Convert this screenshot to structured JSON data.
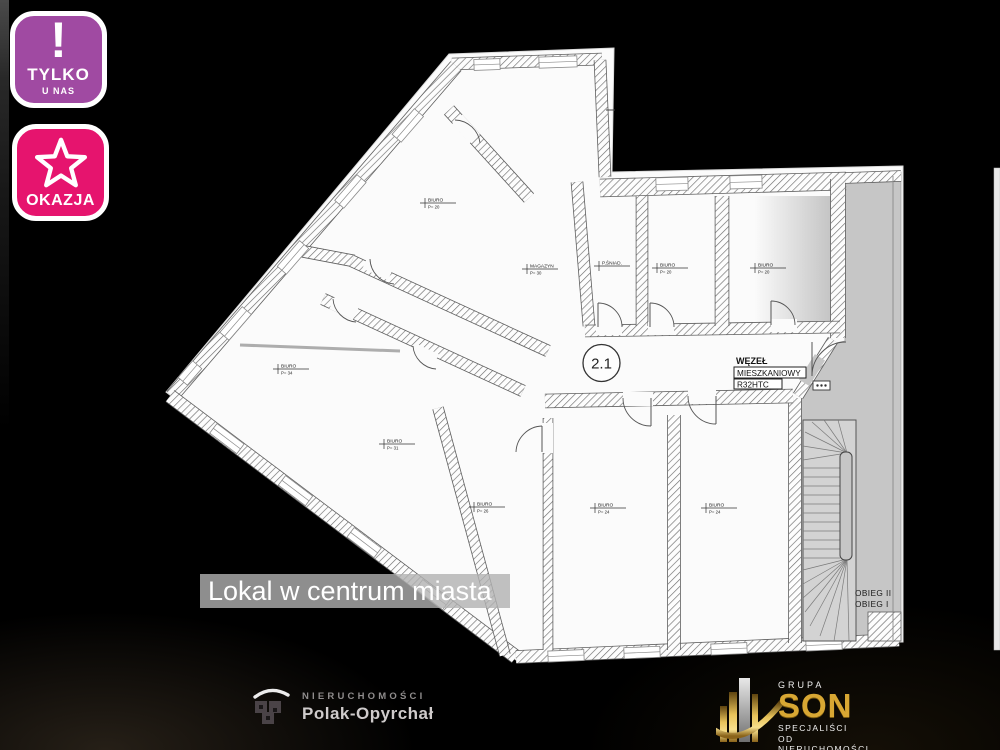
{
  "badges": {
    "tylko": {
      "mark": "!",
      "line1": "TYLKO",
      "line2": "U NAS",
      "bg": "#a04aa2"
    },
    "okazja": {
      "label": "OKAZJA",
      "bg": "#e6146e",
      "icon": "star-icon"
    }
  },
  "caption": {
    "text": "Lokal w centrum miasta"
  },
  "plan": {
    "unit_label": "2.1",
    "wezel": {
      "l1": "WĘZEŁ",
      "l2": "MIESZKANIOWY",
      "l3": "R32HTC"
    },
    "stairs": {
      "flight2": "OBIEG II",
      "flight1": "OBIEG I"
    },
    "rooms": [
      {
        "name": "BIURO",
        "area": "P= 20"
      },
      {
        "name": "MAGAZYN",
        "area": "P= 30"
      },
      {
        "name": "P.ŚNIAD.",
        "area": ""
      },
      {
        "name": "BIURO",
        "area": "P= 20"
      },
      {
        "name": "BIURO",
        "area": "P= 20"
      },
      {
        "name": "BIURO",
        "area": "P= 34"
      },
      {
        "name": "BIURO",
        "area": "P= 31"
      },
      {
        "name": "BIURO",
        "area": "P= 26"
      },
      {
        "name": "BIURO",
        "area": "P= 24"
      },
      {
        "name": "BIURO",
        "area": "P= 24"
      }
    ]
  },
  "footer": {
    "left": {
      "brand": "NIERUCHOMOŚCI",
      "name": "Polak-Opyrchał"
    },
    "right": {
      "group": "GRUPA",
      "name": "SON",
      "tagline1": "SPECJALIŚCI",
      "tagline2": "OD NIERUCHOMOŚCI"
    }
  },
  "colors": {
    "badge_tylko_bg": "#a04aa2",
    "badge_okazja_bg": "#e6146e",
    "caption_bg": "rgba(178,178,178,0.8)",
    "plan_paper": "#fbfbfb",
    "stair_zone_gray": "#c6c6c6",
    "son_gold": "#d8a733",
    "background": "#000000"
  }
}
